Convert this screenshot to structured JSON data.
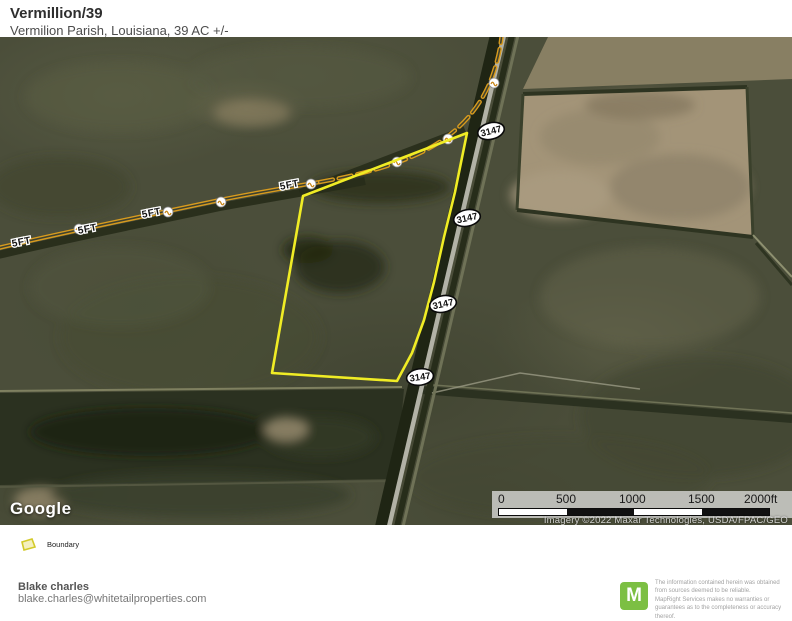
{
  "header": {
    "title": "Vermillion/39",
    "subtitle": "Vermilion Parish, Louisiana, 39 AC +/-"
  },
  "map": {
    "provider": "Google",
    "route_badge_label": "3147",
    "contour_label": "5FT",
    "attribution": "Imagery ©2022 Maxar Technologies, USDA/FPAC/GEO",
    "scale_ticks": [
      "0",
      "500",
      "1000",
      "1500",
      "2000ft"
    ],
    "colors": {
      "boundary_yellow": "#f0ec25",
      "contour_orange": "#d89b1e",
      "road_gray": "#b2b2a6",
      "mapright_green": "#7cbf43"
    }
  },
  "legend": {
    "boundary_label": "Boundary"
  },
  "footer": {
    "agent_name": "Blake charles",
    "agent_email": "blake.charles@whitetailproperties.com"
  },
  "disclaimer": {
    "logo_letter": "M",
    "line1": "The information contained herein was obtained from sources deemed to be reliable.",
    "line2": "MapRight Services makes no warranties or guarantees as to the completeness or accuracy thereof."
  }
}
